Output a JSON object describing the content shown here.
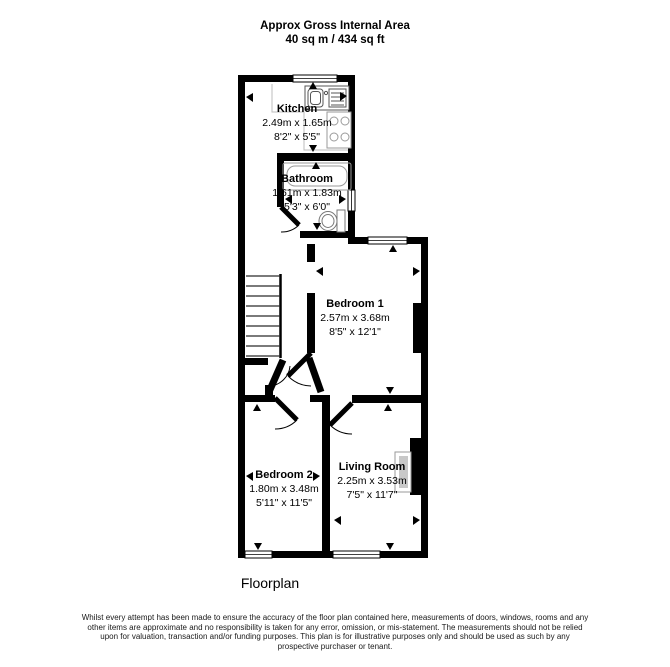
{
  "header": {
    "line1": "Approx Gross Internal Area",
    "line2": "40 sq m / 434 sq ft"
  },
  "rooms": {
    "kitchen": {
      "name": "Kitchen",
      "metric": "2.49m x 1.65m",
      "imperial": "8'2\" x 5'5\""
    },
    "bathroom": {
      "name": "Bathroom",
      "metric": "1.61m x 1.83m",
      "imperial": "5'3\" x 6'0\""
    },
    "bedroom1": {
      "name": "Bedroom 1",
      "metric": "2.57m x 3.68m",
      "imperial": "8'5\" x 12'1\""
    },
    "bedroom2": {
      "name": "Bedroom 2",
      "metric": "1.80m x 3.48m",
      "imperial": "5'11\" x 11'5\""
    },
    "living_room": {
      "name": "Living Room",
      "metric": "2.25m x 3.53m",
      "imperial": "7'5\" x 11'7\""
    }
  },
  "footer": {
    "caption": "Floorplan"
  },
  "disclaimer": "Whilst every attempt has been made to ensure the accuracy of the floor plan contained here, measurements of doors, windows, rooms and any other items are approximate and no responsibility is taken for any error, omission, or mis-statement. The measurements should not be relied upon for valuation, transaction and/or funding purposes. This plan is for illustrative purposes only and should be used as such by any prospective purchaser or tenant.",
  "fixtures": [
    "staircase",
    "bathtub",
    "toilet",
    "sink",
    "hob",
    "fireplace",
    "window",
    "door"
  ],
  "colors": {
    "wall": "#000000",
    "fixture_outline": "#9a9a9a",
    "background": "#ffffff"
  }
}
